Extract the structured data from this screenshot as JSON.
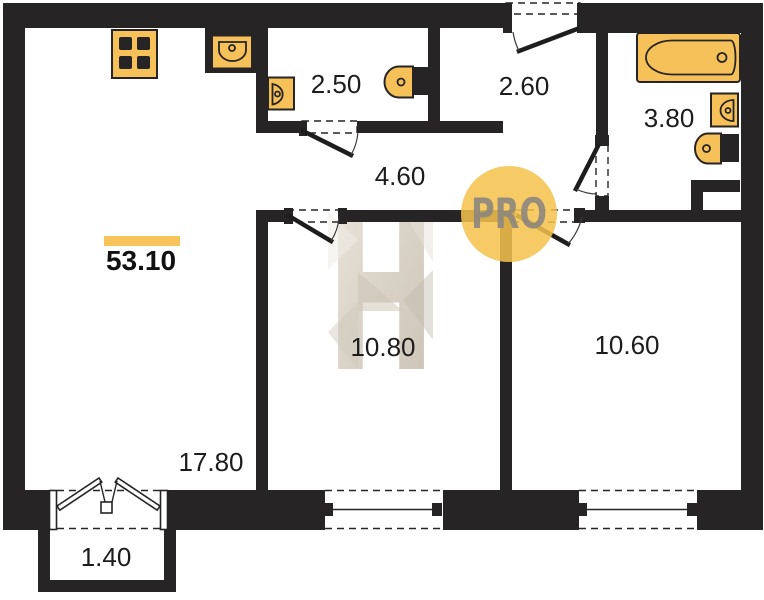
{
  "plan": {
    "title": "apartment-floor-plan",
    "total_area": "53.10",
    "rooms": [
      {
        "name": "living-kitchen",
        "area": "17.80"
      },
      {
        "name": "wc",
        "area": "2.50"
      },
      {
        "name": "entrance-hall",
        "area": "2.60"
      },
      {
        "name": "corridor",
        "area": "4.60"
      },
      {
        "name": "bathroom",
        "area": "3.80"
      },
      {
        "name": "bedroom",
        "area": "10.80"
      },
      {
        "name": "bedroom-2",
        "area": "10.60"
      },
      {
        "name": "balcony",
        "area": "1.40"
      }
    ],
    "fixtures": [
      "stove-icon",
      "kitchen-sink-icon",
      "washbasin-icon",
      "toilet-icon",
      "bathtub-icon",
      "washbasin-icon",
      "toilet-icon"
    ],
    "watermark": {
      "letter": "H",
      "badge": "PRO"
    },
    "colors": {
      "wall": "#262424",
      "fixture": "#F6C159",
      "accent_bar": "#F9C35B",
      "badge_circle": "#F4C34D",
      "badge_text": "#8E887F",
      "watermark_fill": "#D9D2C6"
    }
  }
}
